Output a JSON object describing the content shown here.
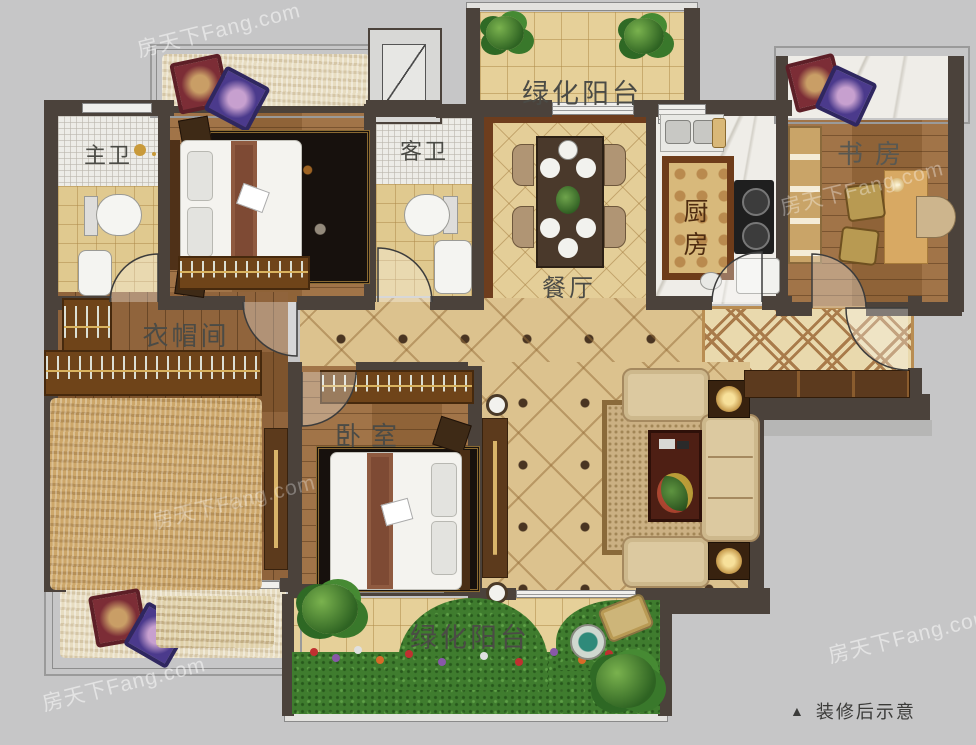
{
  "rooms": {
    "balcony_top": {
      "label": "绿化阳台"
    },
    "master_bath": {
      "label": "主卫"
    },
    "guest_bath": {
      "label": "客卫"
    },
    "dining": {
      "label": "餐厅"
    },
    "kitchen": {
      "label": "厨房"
    },
    "study": {
      "label": "书房"
    },
    "cloakroom": {
      "label": "衣帽间"
    },
    "bedroom": {
      "label": "卧室"
    },
    "balcony_bottom": {
      "label": "绿化阳台"
    }
  },
  "caption": {
    "marker": "▲",
    "text": "装修后示意"
  },
  "watermark": {
    "text": "房天下Fang.com"
  },
  "colors": {
    "background": "#c6c6c7",
    "wall": "#4b423b",
    "wood_floor": "#9b6b3d",
    "tile_floor": "#dcc28e",
    "grass": "#3f7c2e",
    "label_text": "#4b4b46",
    "dining_frame": "#6e3d1d",
    "kitchen_mat": "#d8b97b"
  }
}
